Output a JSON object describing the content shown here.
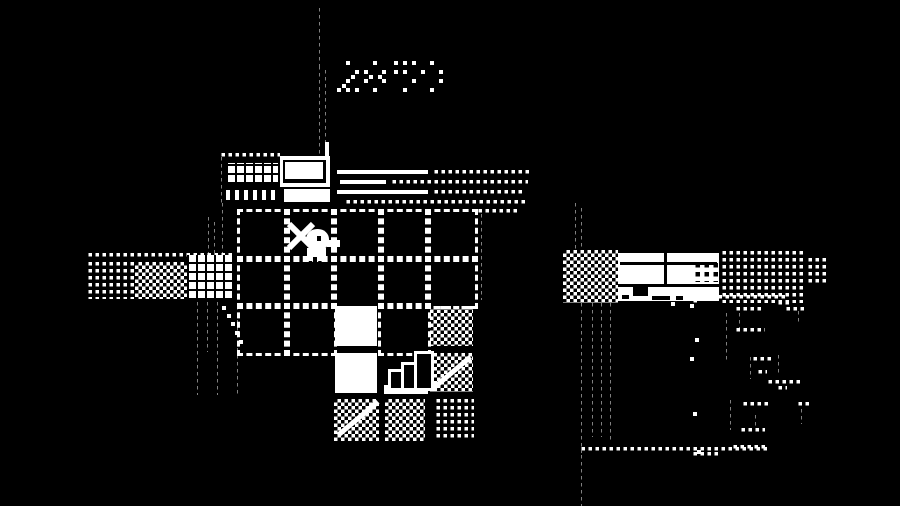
{
  "meta": {
    "background": "#000000",
    "foreground": "#ffffff"
  },
  "hud": {
    "timer_value": "28 59",
    "timer_groups_dither": [
      "dense",
      "sparse"
    ],
    "timer_x": 337,
    "timer_y": 61
  },
  "scene": {
    "sprites": [
      {
        "n": "smoke-dots-top",
        "p": "dotgrid",
        "x": 316,
        "y": 8,
        "w": 4,
        "h": 58
      },
      {
        "n": "smoke-dots-mid-left",
        "p": "dotgrid",
        "x": 316,
        "y": 66,
        "w": 4,
        "h": 88
      },
      {
        "n": "smoke-dots-mid-right",
        "p": "dotgrid",
        "x": 322,
        "y": 70,
        "w": 4,
        "h": 84
      },
      {
        "n": "chimney-stub",
        "p": "solid",
        "x": 325,
        "y": 142,
        "w": 4,
        "h": 16
      },
      {
        "n": "roof-edge-dots-top",
        "p": "dotgrid",
        "x": 218,
        "y": 153,
        "w": 62,
        "h": 4
      },
      {
        "n": "roof-edge-dots-left",
        "p": "dotgrid",
        "x": 218,
        "y": 157,
        "w": 4,
        "h": 46
      },
      {
        "n": "roof-hatch-block",
        "p": "hatch",
        "x": 226,
        "y": 163,
        "w": 52,
        "h": 21
      },
      {
        "n": "roof-fringe-comb",
        "p": "comb",
        "x": 226,
        "y": 190,
        "w": 52,
        "h": 10
      },
      {
        "n": "building-front-frame",
        "p": "solid",
        "x": 280,
        "y": 156,
        "w": 50,
        "h": 31
      },
      {
        "n": "building-front-inset",
        "p": "black",
        "x": 283,
        "y": 160,
        "w": 43,
        "h": 23
      },
      {
        "n": "building-door-panel",
        "p": "solid",
        "x": 285,
        "y": 162,
        "w": 38,
        "h": 17
      },
      {
        "n": "building-porch",
        "p": "solid",
        "x": 284,
        "y": 189,
        "w": 46,
        "h": 13
      },
      {
        "n": "awning-line-1",
        "p": "solid",
        "x": 337,
        "y": 170,
        "w": 91,
        "h": 4
      },
      {
        "n": "awning-line-1-dots",
        "p": "dotgrid",
        "x": 431,
        "y": 170,
        "w": 100,
        "h": 4
      },
      {
        "n": "awning-line-2",
        "p": "solid",
        "x": 340,
        "y": 180,
        "w": 46,
        "h": 4
      },
      {
        "n": "awning-line-2-dots",
        "p": "dotgrid",
        "x": 389,
        "y": 180,
        "w": 139,
        "h": 4
      },
      {
        "n": "awning-line-3",
        "p": "solid",
        "x": 337,
        "y": 190,
        "w": 91,
        "h": 4
      },
      {
        "n": "awning-line-3-dots",
        "p": "dotgrid",
        "x": 431,
        "y": 190,
        "w": 94,
        "h": 4
      },
      {
        "n": "awning-line-4-dots",
        "p": "dotgrid",
        "x": 343,
        "y": 200,
        "w": 185,
        "h": 4
      },
      {
        "n": "path-dots-grid-topright",
        "p": "dotgrid",
        "x": 475,
        "y": 209,
        "w": 42,
        "h": 4
      },
      {
        "n": "grid-right-dotted-edge",
        "p": "dotgrid",
        "x": 478,
        "y": 214,
        "w": 4,
        "h": 86
      },
      {
        "n": "floor-tile",
        "p": "dash",
        "x": 237,
        "y": 209,
        "w": 47,
        "h": 47
      },
      {
        "n": "floor-tile",
        "p": "dash",
        "x": 284,
        "y": 209,
        "w": 47,
        "h": 47
      },
      {
        "n": "floor-tile",
        "p": "dash",
        "x": 331,
        "y": 209,
        "w": 47,
        "h": 47
      },
      {
        "n": "floor-tile",
        "p": "dash",
        "x": 378,
        "y": 209,
        "w": 47,
        "h": 47
      },
      {
        "n": "floor-tile",
        "p": "dash",
        "x": 425,
        "y": 209,
        "w": 47,
        "h": 47
      },
      {
        "n": "floor-tile",
        "p": "dash",
        "x": 237,
        "y": 256,
        "w": 47,
        "h": 47
      },
      {
        "n": "floor-tile",
        "p": "dash",
        "x": 284,
        "y": 256,
        "w": 47,
        "h": 47
      },
      {
        "n": "floor-tile",
        "p": "dash",
        "x": 331,
        "y": 256,
        "w": 47,
        "h": 47
      },
      {
        "n": "floor-tile",
        "p": "dash",
        "x": 378,
        "y": 256,
        "w": 47,
        "h": 47
      },
      {
        "n": "floor-tile",
        "p": "dash",
        "x": 425,
        "y": 256,
        "w": 47,
        "h": 47
      },
      {
        "n": "floor-tile",
        "p": "dash",
        "x": 237,
        "y": 303,
        "w": 47,
        "h": 47
      },
      {
        "n": "floor-tile",
        "p": "dash",
        "x": 284,
        "y": 303,
        "w": 47,
        "h": 47
      },
      {
        "n": "floor-tile",
        "p": "dash",
        "x": 378,
        "y": 303,
        "w": 47,
        "h": 47
      },
      {
        "n": "white-tile-1",
        "p": "solid",
        "x": 335,
        "y": 306,
        "w": 42,
        "h": 40
      },
      {
        "n": "white-tile-2",
        "p": "solid",
        "x": 335,
        "y": 353,
        "w": 42,
        "h": 40
      },
      {
        "n": "checker-tile-1",
        "p": "checker",
        "x": 430,
        "y": 306,
        "w": 43,
        "h": 40
      },
      {
        "n": "checker-tile-2",
        "p": "checker",
        "x": 430,
        "y": 353,
        "w": 43,
        "h": 39
      },
      {
        "n": "checker-tile-2-streak",
        "p": "solid",
        "x": 428,
        "y": 370,
        "w": 48,
        "h": 5,
        "r": -40
      },
      {
        "n": "checker-tile-3",
        "p": "checker",
        "x": 334,
        "y": 399,
        "w": 45,
        "h": 42
      },
      {
        "n": "checker-tile-3-streak",
        "p": "solid",
        "x": 332,
        "y": 416,
        "w": 52,
        "h": 5,
        "r": -40
      },
      {
        "n": "checker-tile-4",
        "p": "checker",
        "x": 385,
        "y": 399,
        "w": 40,
        "h": 42
      },
      {
        "n": "dot-tile",
        "p": "dotgrid",
        "x": 433,
        "y": 399,
        "w": 41,
        "h": 42
      },
      {
        "n": "grid-left-dotted-edge",
        "p": "dotgrid",
        "x": 234,
        "y": 306,
        "w": 4,
        "h": 90
      },
      {
        "n": "chart-base",
        "p": "solid",
        "x": 384,
        "y": 385,
        "w": 44,
        "h": 9
      },
      {
        "n": "chart-bar-1",
        "p": "barOutline",
        "x": 388,
        "y": 369,
        "w": 12,
        "h": 16
      },
      {
        "n": "chart-bar-2",
        "p": "barOutline",
        "x": 401,
        "y": 362,
        "w": 13,
        "h": 23
      },
      {
        "n": "chart-bar-3",
        "p": "barOutline",
        "x": 414,
        "y": 351,
        "w": 14,
        "h": 34
      },
      {
        "n": "sword-slash-a",
        "p": "solid",
        "x": 284,
        "y": 233,
        "w": 34,
        "h": 6,
        "r": 45
      },
      {
        "n": "sword-slash-b",
        "p": "solid",
        "x": 284,
        "y": 233,
        "w": 34,
        "h": 6,
        "r": -45
      },
      {
        "n": "player-head",
        "p": "solid round",
        "x": 306,
        "y": 229,
        "w": 23,
        "h": 21
      },
      {
        "n": "player-eye",
        "p": "black",
        "x": 317,
        "y": 236,
        "w": 4,
        "h": 5
      },
      {
        "n": "player-beak",
        "p": "solid",
        "x": 327,
        "y": 240,
        "w": 13,
        "h": 7
      },
      {
        "n": "player-body",
        "p": "solid",
        "x": 307,
        "y": 248,
        "w": 19,
        "h": 13
      },
      {
        "n": "player-leg-gap",
        "p": "black",
        "x": 313,
        "y": 257,
        "w": 4,
        "h": 5
      },
      {
        "n": "meadow-top-dots",
        "p": "dotgrid",
        "x": 85,
        "y": 253,
        "w": 147,
        "h": 4
      },
      {
        "n": "meadow-dot-field",
        "p": "dotgrid",
        "x": 85,
        "y": 262,
        "w": 50,
        "h": 37
      },
      {
        "n": "meadow-checker-field",
        "p": "checker",
        "x": 135,
        "y": 262,
        "w": 52,
        "h": 37
      },
      {
        "n": "meadow-hatch-block",
        "p": "hatch",
        "x": 187,
        "y": 255,
        "w": 45,
        "h": 45
      },
      {
        "n": "fence-dots-upper-1",
        "p": "dotgrid",
        "x": 205,
        "y": 217,
        "w": 4,
        "h": 40
      },
      {
        "n": "fence-dots-upper-2",
        "p": "dotgrid",
        "x": 211,
        "y": 222,
        "w": 4,
        "h": 34
      },
      {
        "n": "fence-dots-upper-3",
        "p": "dotgrid",
        "x": 219,
        "y": 203,
        "w": 4,
        "h": 52
      },
      {
        "n": "fence-dots-1",
        "p": "dotgrid",
        "x": 194,
        "y": 302,
        "w": 4,
        "h": 93
      },
      {
        "n": "fence-dots-2",
        "p": "dotgrid",
        "x": 204,
        "y": 302,
        "w": 4,
        "h": 50
      },
      {
        "n": "fence-dots-3",
        "p": "dotgrid",
        "x": 214,
        "y": 302,
        "w": 4,
        "h": 93
      },
      {
        "n": "scatter-dot",
        "p": "solid",
        "x": 222,
        "y": 306,
        "w": 4,
        "h": 4
      },
      {
        "n": "scatter-dot",
        "p": "solid",
        "x": 227,
        "y": 314,
        "w": 4,
        "h": 4
      },
      {
        "n": "scatter-dot",
        "p": "solid",
        "x": 231,
        "y": 322,
        "w": 4,
        "h": 4
      },
      {
        "n": "scatter-dot",
        "p": "solid",
        "x": 235,
        "y": 331,
        "w": 4,
        "h": 4
      },
      {
        "n": "scatter-dot",
        "p": "solid",
        "x": 239,
        "y": 340,
        "w": 4,
        "h": 4
      },
      {
        "n": "river-dots-upper-1",
        "p": "dotgrid",
        "x": 572,
        "y": 203,
        "w": 4,
        "h": 49
      },
      {
        "n": "river-dots-upper-2",
        "p": "dotgrid",
        "x": 578,
        "y": 208,
        "w": 4,
        "h": 44
      },
      {
        "n": "shore-checker",
        "p": "checker",
        "x": 563,
        "y": 250,
        "w": 55,
        "h": 53
      },
      {
        "n": "white-building",
        "p": "solid",
        "x": 618,
        "y": 253,
        "w": 101,
        "h": 48
      },
      {
        "n": "building-roof-seam",
        "p": "black",
        "x": 620,
        "y": 262,
        "w": 97,
        "h": 3
      },
      {
        "n": "building-wall-divider",
        "p": "black",
        "x": 664,
        "y": 253,
        "w": 3,
        "h": 31
      },
      {
        "n": "building-windows",
        "p": "windots",
        "x": 691,
        "y": 263,
        "w": 27,
        "h": 19
      },
      {
        "n": "building-floor-seam",
        "p": "black",
        "x": 618,
        "y": 284,
        "w": 101,
        "h": 3
      },
      {
        "n": "building-door",
        "p": "black",
        "x": 633,
        "y": 287,
        "w": 15,
        "h": 9
      },
      {
        "n": "building-base-notch-1",
        "p": "black",
        "x": 622,
        "y": 295,
        "w": 7,
        "h": 4
      },
      {
        "n": "building-base-notch-2",
        "p": "black",
        "x": 652,
        "y": 296,
        "w": 18,
        "h": 4
      },
      {
        "n": "building-base-notch-3",
        "p": "black",
        "x": 676,
        "y": 296,
        "w": 7,
        "h": 4
      },
      {
        "n": "forest-dots-a",
        "p": "dotgrid",
        "x": 719,
        "y": 251,
        "w": 86,
        "h": 52
      },
      {
        "n": "forest-dots-b",
        "p": "dotgrid",
        "x": 805,
        "y": 258,
        "w": 24,
        "h": 28
      },
      {
        "n": "river-dots-1",
        "p": "dotgrid",
        "x": 578,
        "y": 303,
        "w": 4,
        "h": 150
      },
      {
        "n": "river-dots-2",
        "p": "dotgrid",
        "x": 589,
        "y": 303,
        "w": 4,
        "h": 134
      },
      {
        "n": "river-dots-3",
        "p": "dotgrid",
        "x": 598,
        "y": 303,
        "w": 4,
        "h": 134
      },
      {
        "n": "river-dots-4",
        "p": "dotgrid",
        "x": 607,
        "y": 303,
        "w": 4,
        "h": 138
      },
      {
        "n": "river-dots-5",
        "p": "dotgrid",
        "x": 578,
        "y": 455,
        "w": 4,
        "h": 51
      },
      {
        "n": "shore-dots-bottom",
        "p": "dotgrid",
        "x": 578,
        "y": 447,
        "w": 190,
        "h": 4
      },
      {
        "n": "shore-dots-bottom-2",
        "p": "dotgrid",
        "x": 690,
        "y": 452,
        "w": 30,
        "h": 4
      },
      {
        "n": "forest-fragment",
        "p": "dotgrid",
        "x": 708,
        "y": 295,
        "w": 80,
        "h": 4
      },
      {
        "n": "forest-fragment",
        "p": "dotgrid",
        "x": 690,
        "y": 299,
        "w": 10,
        "h": 4
      },
      {
        "n": "forest-fragment",
        "p": "dotgrid",
        "x": 775,
        "y": 301,
        "w": 16,
        "h": 4
      },
      {
        "n": "forest-fragment",
        "p": "dotgrid",
        "x": 783,
        "y": 307,
        "w": 22,
        "h": 4
      },
      {
        "n": "forest-fragment",
        "p": "dotgrid",
        "x": 795,
        "y": 311,
        "w": 4,
        "h": 14
      },
      {
        "n": "forest-fragment",
        "p": "dotgrid",
        "x": 733,
        "y": 307,
        "w": 30,
        "h": 4
      },
      {
        "n": "forest-fragment",
        "p": "dotgrid",
        "x": 723,
        "y": 313,
        "w": 4,
        "h": 20
      },
      {
        "n": "forest-fragment",
        "p": "dotgrid",
        "x": 736,
        "y": 313,
        "w": 4,
        "h": 16
      },
      {
        "n": "forest-fragment",
        "p": "dotgrid",
        "x": 733,
        "y": 328,
        "w": 32,
        "h": 4
      },
      {
        "n": "forest-fragment",
        "p": "dotgrid",
        "x": 723,
        "y": 335,
        "w": 4,
        "h": 25
      },
      {
        "n": "forest-fragment",
        "p": "dotgrid",
        "x": 747,
        "y": 357,
        "w": 4,
        "h": 22
      },
      {
        "n": "forest-fragment",
        "p": "dotgrid",
        "x": 750,
        "y": 357,
        "w": 22,
        "h": 4
      },
      {
        "n": "forest-fragment",
        "p": "dotgrid",
        "x": 755,
        "y": 370,
        "w": 12,
        "h": 4
      },
      {
        "n": "forest-fragment",
        "p": "dotgrid",
        "x": 775,
        "y": 355,
        "w": 4,
        "h": 18
      },
      {
        "n": "forest-fragment",
        "p": "dotgrid",
        "x": 765,
        "y": 380,
        "w": 38,
        "h": 4
      },
      {
        "n": "forest-fragment",
        "p": "dotgrid",
        "x": 775,
        "y": 386,
        "w": 12,
        "h": 4
      },
      {
        "n": "forest-fragment",
        "p": "dotgrid",
        "x": 727,
        "y": 400,
        "w": 4,
        "h": 30
      },
      {
        "n": "forest-fragment",
        "p": "dotgrid",
        "x": 740,
        "y": 402,
        "w": 28,
        "h": 4
      },
      {
        "n": "forest-fragment",
        "p": "dotgrid",
        "x": 738,
        "y": 428,
        "w": 27,
        "h": 4
      },
      {
        "n": "forest-fragment",
        "p": "dotgrid",
        "x": 752,
        "y": 415,
        "w": 4,
        "h": 15
      },
      {
        "n": "forest-fragment",
        "p": "dotgrid",
        "x": 798,
        "y": 402,
        "w": 4,
        "h": 22
      },
      {
        "n": "forest-fragment",
        "p": "dotgrid",
        "x": 795,
        "y": 402,
        "w": 15,
        "h": 4
      },
      {
        "n": "forest-fragment",
        "p": "dotgrid",
        "x": 730,
        "y": 445,
        "w": 36,
        "h": 4
      },
      {
        "n": "stray-dot",
        "p": "solid",
        "x": 695,
        "y": 338,
        "w": 4,
        "h": 4
      },
      {
        "n": "stray-dot",
        "p": "solid",
        "x": 690,
        "y": 357,
        "w": 4,
        "h": 4
      },
      {
        "n": "stray-dot",
        "p": "solid",
        "x": 693,
        "y": 412,
        "w": 4,
        "h": 4
      },
      {
        "n": "stray-dot",
        "p": "solid",
        "x": 697,
        "y": 450,
        "w": 4,
        "h": 4
      },
      {
        "n": "stray-dot",
        "p": "solid",
        "x": 671,
        "y": 302,
        "w": 4,
        "h": 4
      },
      {
        "n": "stray-dot",
        "p": "solid",
        "x": 690,
        "y": 304,
        "w": 4,
        "h": 4
      }
    ]
  }
}
